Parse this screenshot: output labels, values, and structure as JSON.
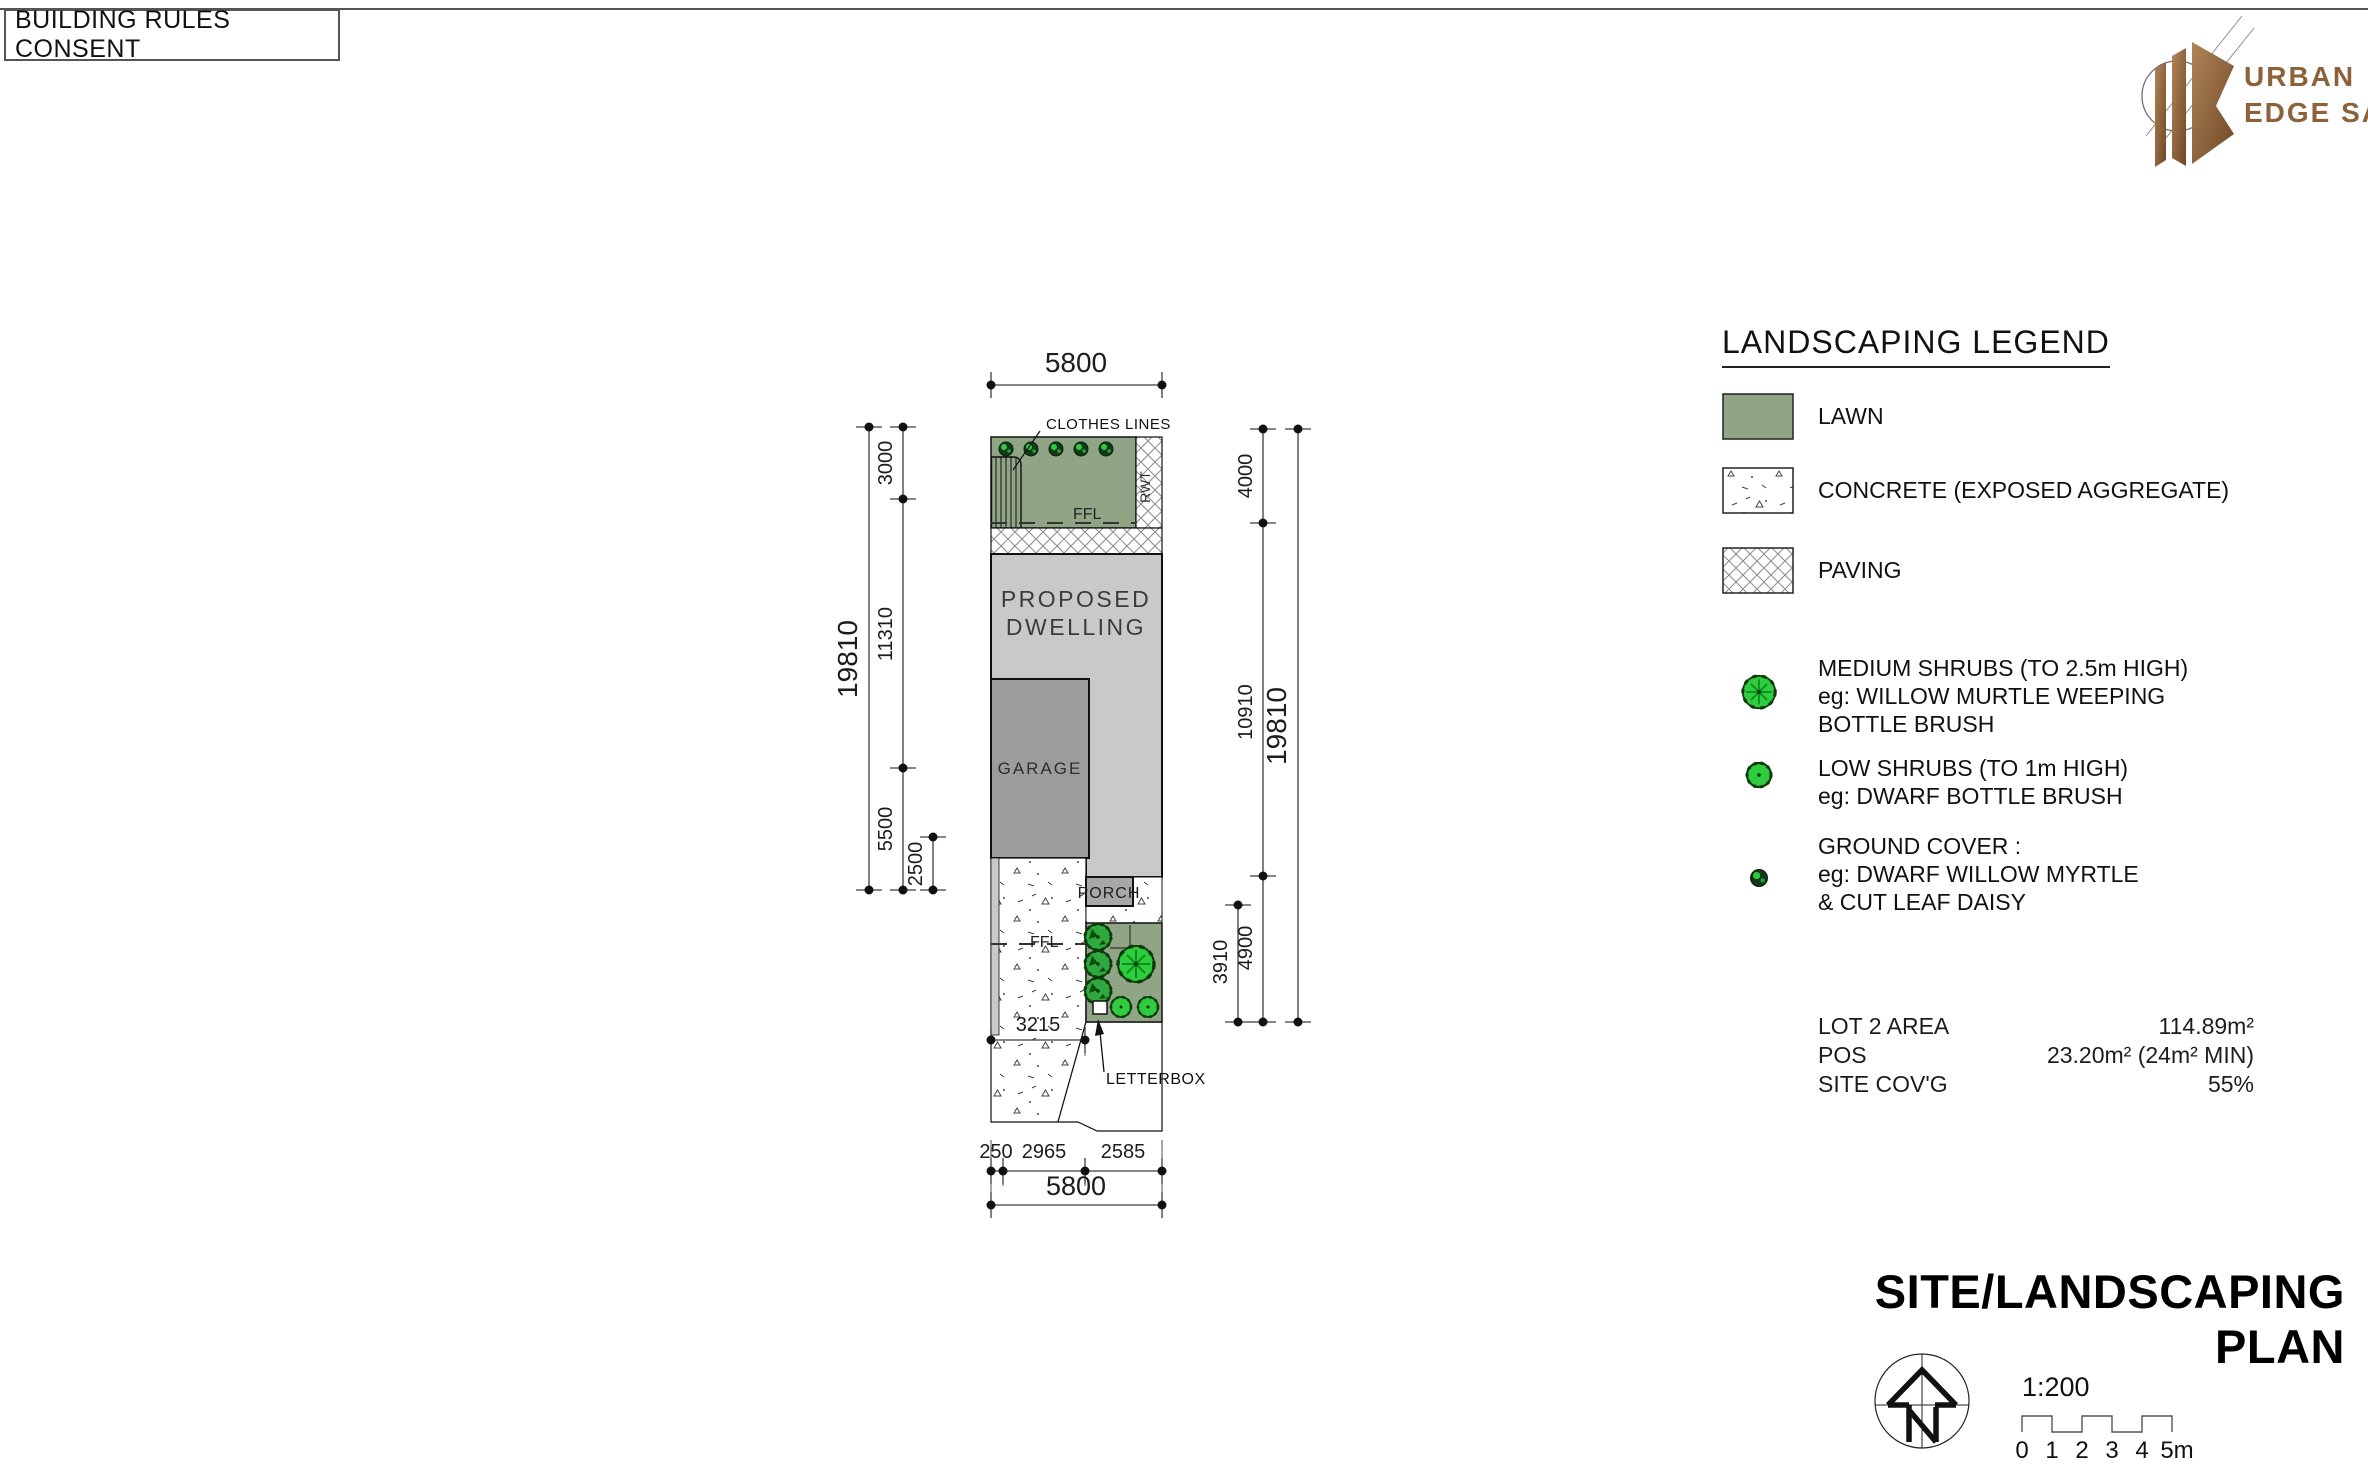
{
  "sheet": {
    "title_box": "BUILDING RULES CONSENT"
  },
  "logo": {
    "line1": "URBAN",
    "line2": "EDGE SA",
    "color": "#8C6239"
  },
  "plan": {
    "labels": {
      "clothes_lines": "CLOTHES LINES",
      "rwt": "RWT",
      "ffl_rear": "FFL",
      "ffl_front": "FFL",
      "dwelling_line1": "PROPOSED",
      "dwelling_line2": "DWELLING",
      "garage": "GARAGE",
      "porch": "PORCH",
      "letterbox": "LETTERBOX"
    },
    "dims": {
      "top_width": "5800",
      "left_total": "19810",
      "left_seg_1": "3000",
      "left_seg_2": "11310",
      "left_seg_3": "5500",
      "left_inner": "2500",
      "right_total": "19810",
      "right_seg_1": "4000",
      "right_seg_2": "10910",
      "right_seg_3": "4900",
      "right_inner": "3910",
      "front_offset": "3215",
      "bot_seg_1": "250",
      "bot_seg_2": "2965",
      "bot_seg_3": "2585",
      "bottom_width": "5800"
    },
    "colors": {
      "lawn": "#8FA585",
      "dwelling": "#C9C9C9",
      "garage": "#9C9C9C",
      "porch": "#A8A8A8",
      "shrub_bright": "#2FCC3F",
      "shrub_dark": "#0B3B0B"
    }
  },
  "legend": {
    "title": "LANDSCAPING LEGEND",
    "items": [
      {
        "label": "LAWN"
      },
      {
        "label": "CONCRETE (EXPOSED AGGREGATE)"
      },
      {
        "label": "PAVING"
      },
      {
        "line1": "MEDIUM SHRUBS (TO 2.5m HIGH)",
        "line2": "eg: WILLOW MURTLE WEEPING",
        "line3": "BOTTLE BRUSH"
      },
      {
        "line1": "LOW SHRUBS (TO 1m HIGH)",
        "line2": "eg: DWARF BOTTLE BRUSH"
      },
      {
        "line1": "GROUND COVER :",
        "line2": "eg: DWARF WILLOW MYRTLE",
        "line3": "& CUT LEAF DAISY"
      }
    ],
    "stats": [
      {
        "label": "LOT 2 AREA",
        "value": "114.89m²"
      },
      {
        "label": "POS",
        "value": "23.20m² (24m² MIN)"
      },
      {
        "label": "SITE COV'G",
        "value": "55%"
      }
    ]
  },
  "titleblock": {
    "plan_title": "SITE/LANDSCAPING PLAN",
    "scale_label": "1:200",
    "scale_ticks": [
      "0",
      "1",
      "2",
      "3",
      "4",
      "5m"
    ]
  }
}
